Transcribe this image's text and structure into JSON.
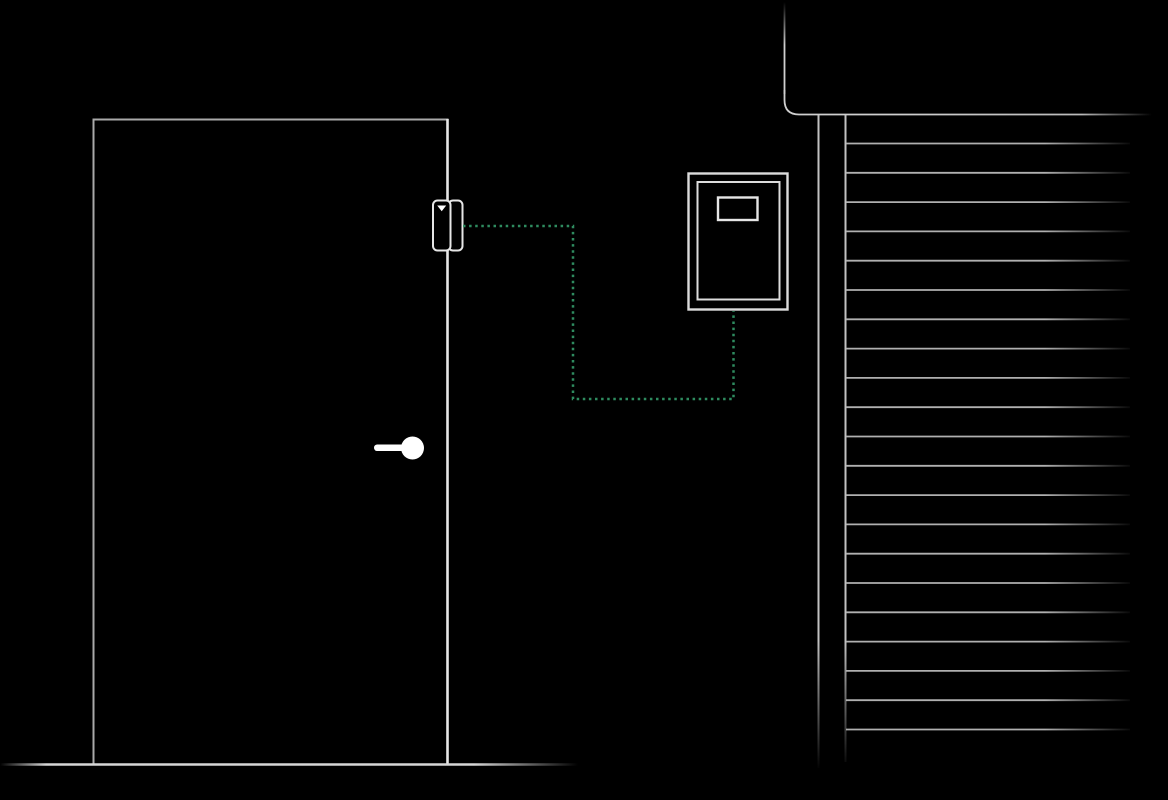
{
  "scene": {
    "description": "Smart-home security illustration: a magnetic door-opening sensor mounted on a door edge, linked by a dotted wireless path to a wall-mounted control panel, beside a window covered by closed horizontal blinds",
    "colors": {
      "background": "#000000",
      "line": "#a9a9a9",
      "bright_line": "#e6e6e6",
      "panel_line": "#dcdcdc",
      "frame_line": "#c2c2c2",
      "slat_line": "#b0b0b0",
      "floor_line": "#d6d6d6",
      "white": "#ffffff",
      "accent_green": "#2e8b5f"
    },
    "elements": {
      "door": {
        "name": "door"
      },
      "door_handle": {
        "name": "door handle (lever with round knob)"
      },
      "door_sensor": {
        "name": "magnetic door-opening sensor, two-part, with downward triangle marker"
      },
      "connection": {
        "name": "wireless link",
        "from": "door-sensor",
        "to": "control-panel",
        "style": "dotted"
      },
      "control_panel": {
        "name": "wall-mounted control panel with small display"
      },
      "wall": {
        "name": "wall corner outline with rounded bend"
      },
      "window_blinds": {
        "name": "window with closed horizontal blinds"
      },
      "floor": {
        "name": "floor line"
      }
    }
  },
  "blinds": {
    "slat_count": 21,
    "x_start": 846,
    "x_end": 1130,
    "y_start": 143.5,
    "spacing": 29.3
  }
}
